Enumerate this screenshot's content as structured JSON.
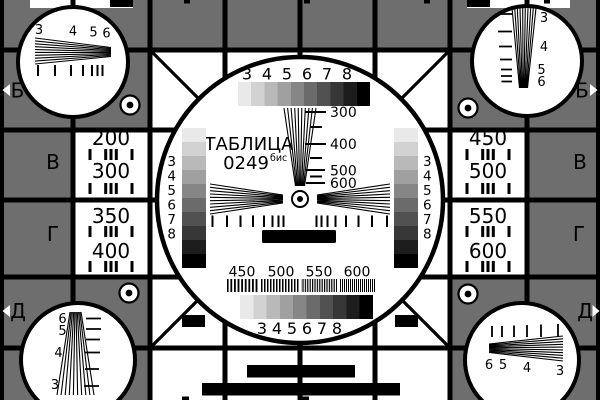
{
  "card": {
    "title": "ТАБЛИЦА",
    "code": "0249",
    "code_suffix": "бис"
  },
  "colors": {
    "background": "#6e6e6e",
    "cell": "#ffffff",
    "line": "#000000"
  },
  "grayscale_steps": [
    "#e9e9e9",
    "#d2d2d2",
    "#b9b9b9",
    "#a0a0a0",
    "#868686",
    "#6b6b6b",
    "#515151",
    "#373737",
    "#1d1d1d",
    "#000000"
  ],
  "row_labels": {
    "left": [
      "Б",
      "В",
      "Г",
      "Д"
    ],
    "right": [
      "Б",
      "В",
      "Г",
      "Д"
    ]
  },
  "frequency_cells": {
    "left_top": [
      "200",
      "300"
    ],
    "left_bottom": [
      "350",
      "400"
    ],
    "right_top": [
      "450",
      "500"
    ],
    "right_bottom": [
      "550",
      "600"
    ]
  },
  "center": {
    "top_scale": [
      "3",
      "4",
      "5",
      "6",
      "7",
      "8"
    ],
    "bottom_scale": [
      "3",
      "4",
      "5",
      "6",
      "7",
      "8"
    ],
    "left_gray_scale": [
      "3",
      "4",
      "5",
      "6",
      "7",
      "8"
    ],
    "right_gray_scale": [
      "3",
      "4",
      "5",
      "6",
      "7",
      "8"
    ],
    "wedge_scale": [
      "300",
      "400",
      "500",
      "600"
    ],
    "burst_scale": [
      "450",
      "500",
      "550",
      "600"
    ]
  },
  "corner_wedges": {
    "top_left": [
      "3",
      "4",
      "5",
      "6"
    ],
    "top_right": [
      "3",
      "4",
      "5",
      "6"
    ],
    "bottom_left": [
      "6",
      "5",
      "4",
      "3"
    ],
    "bottom_right": [
      "6",
      "5",
      "4",
      "3"
    ]
  }
}
